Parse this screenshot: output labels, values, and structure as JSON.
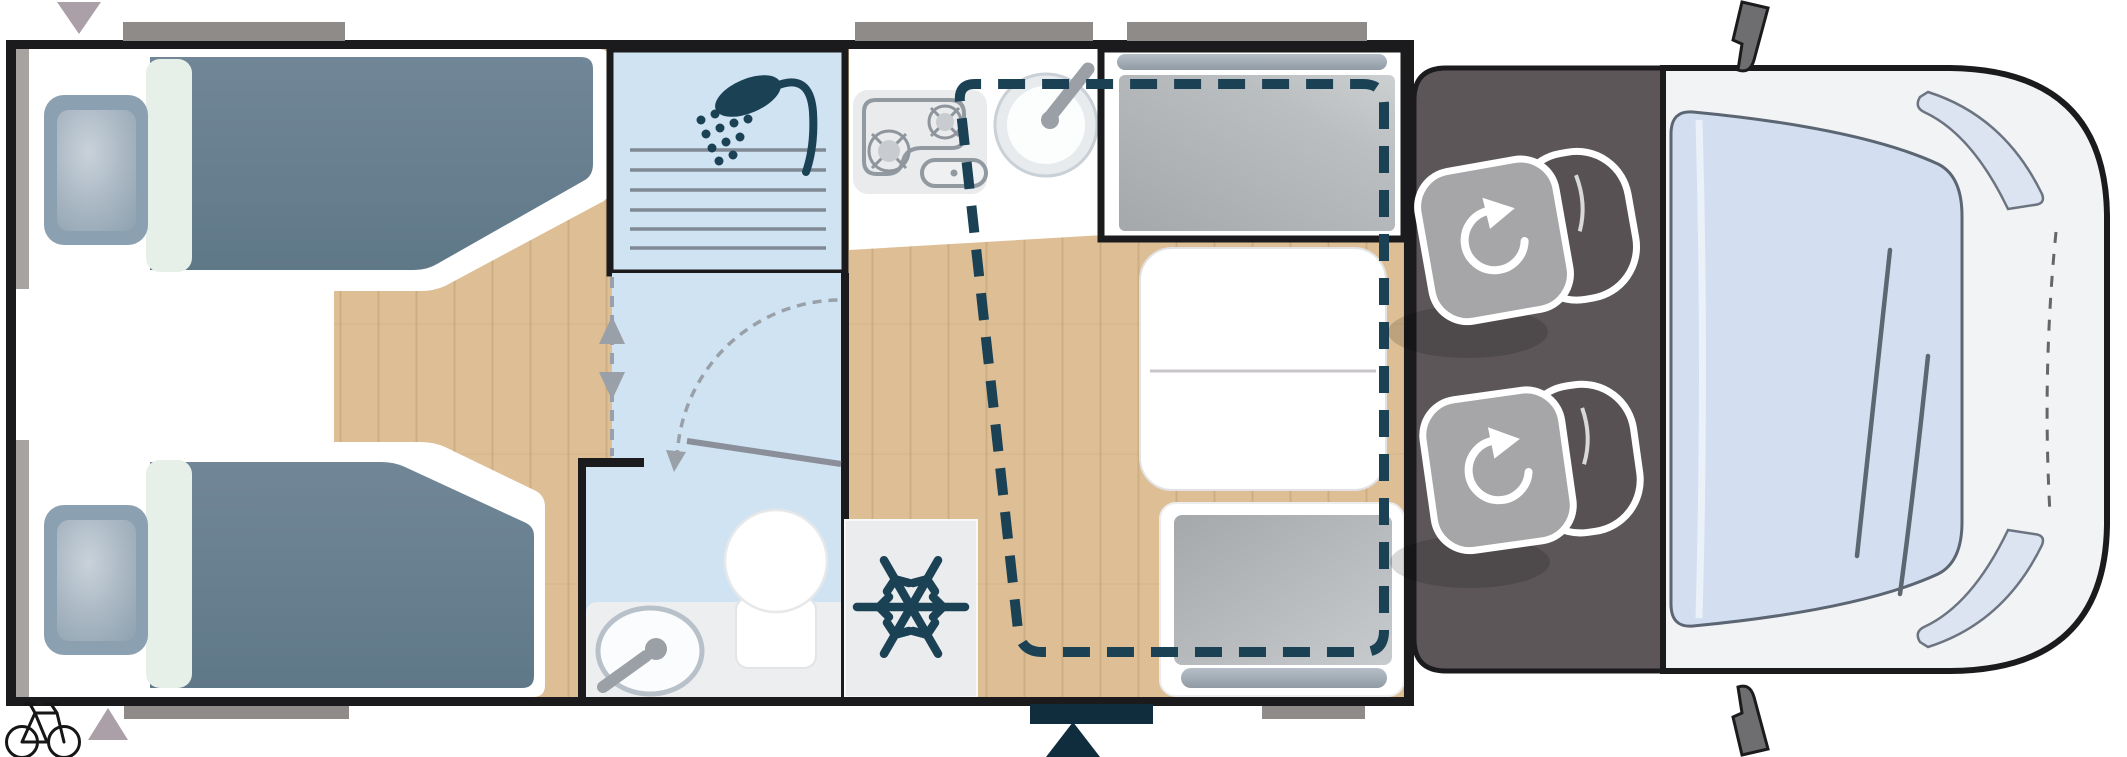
{
  "canvas": {
    "width": 2127,
    "height": 757
  },
  "palette": {
    "ink": "#1b1b1d",
    "wood": "#debf95",
    "wood-line": "#c0a074",
    "water-blue": "#cfe3f3",
    "navy": "#1b4155",
    "entry-navy": "#0f2d3d",
    "blanket": "#69808f",
    "pillow": "#8ba0b0",
    "mint": "#e7efe9",
    "window-gray": "#8f8b88",
    "side-window-gray": "#a7a3a1",
    "marker-gray": "#ab9fa8",
    "cab-floor": "#5c5659",
    "seat-cushion": "#a6a6a9",
    "seat-back": "#575153",
    "body-gray": "#f2f3f5",
    "glass-blue": "#d3dff1",
    "glass-edge": "#5c6673",
    "fixture-gray": "#9aa0a6",
    "counter-gray": "#eceef0",
    "cushion-gray": "#b2b5b8",
    "door-gray": "#8a8f99",
    "line-gray": "#818a94",
    "mirror-gray": "#6e6e70"
  },
  "icons": {
    "shower": {
      "name": "shower-icon",
      "label": "shower"
    },
    "snowflake": {
      "name": "snowflake-icon",
      "label": "refrigerator"
    },
    "bicycle": {
      "name": "bicycle-icon",
      "label": "bike storage"
    },
    "swivel": {
      "name": "rotate-arrow-icon",
      "label": "swivel seat"
    },
    "doorswing": {
      "name": "door-swing-arc-icon",
      "label": "bathroom door swing"
    },
    "slide": {
      "name": "sliding-door-arrows-icon",
      "label": "sliding partition"
    },
    "entry": {
      "name": "entry-triangle-icon",
      "label": "entrance"
    },
    "awning": {
      "name": "marker-triangle-icon",
      "label": "marker"
    }
  },
  "legend": {
    "dashed_navy_outline": "drop-down-bed-outline",
    "dashed_gray_arc": "door-swing",
    "gray_rectangles": "windows",
    "navy_rectangle": "entrance-step"
  }
}
